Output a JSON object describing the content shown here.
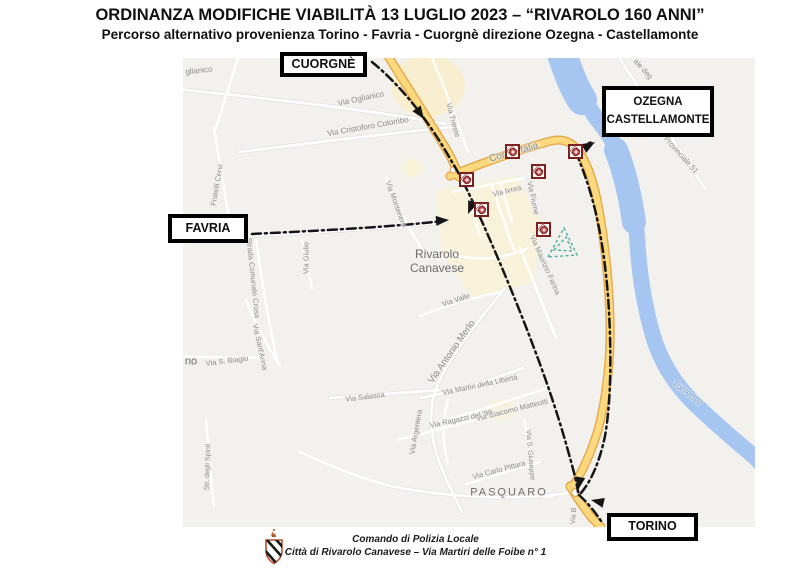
{
  "header": {
    "title": "ORDINANZA MODIFICHE VIABILITÀ 13 LUGLIO 2023 – “RIVAROLO 160 ANNI”",
    "subtitle": "Percorso alternativo provenienza Torino - Favria - Cuorgnè direzione Ozegna - Castellamonte"
  },
  "route_boxes": {
    "cuorgne": {
      "label": "CUORGNÈ"
    },
    "favria": {
      "label": "FAVRIA"
    },
    "ozegna": {
      "line1": "OZEGNA",
      "line2": "CASTELLAMONTE"
    },
    "torino": {
      "label": "TORINO"
    }
  },
  "map": {
    "colors": {
      "highlight_road": "#fcd97e",
      "highlight_casing": "#e4a94b",
      "route_dash": "#151515",
      "water": "#a6c6f1",
      "closure_marker_border": "#7b1f1f",
      "map_background": "#f2f1ee"
    },
    "town_labels": [
      {
        "lines": [
          "Rivarolo",
          "Canavese"
        ],
        "x": 437,
        "y": 262,
        "size": 12
      },
      {
        "lines": [
          "PASQUARO"
        ],
        "x": 509,
        "y": 493,
        "size": 11,
        "ls": 2
      },
      {
        "lines": [
          "no"
        ],
        "x": 191,
        "y": 362,
        "size": 11
      }
    ],
    "street_labels": [
      {
        "text": "glianico",
        "x": 199,
        "y": 71,
        "rot": -6,
        "size": 8
      },
      {
        "text": "Via Oglianico",
        "x": 361,
        "y": 99,
        "rot": -12,
        "size": 8
      },
      {
        "text": "Via Cristoforo Colombo",
        "x": 368,
        "y": 127,
        "rot": -10,
        "size": 8
      },
      {
        "text": "Fratelli Cervi",
        "x": 217,
        "y": 185,
        "rot": -80,
        "size": 7.5
      },
      {
        "text": "Via Trieste",
        "x": 453,
        "y": 120,
        "rot": 75,
        "size": 7.5
      },
      {
        "text": "Corso Italia",
        "x": 514,
        "y": 153,
        "rot": -16,
        "size": 10
      },
      {
        "text": "Via Ivrea",
        "x": 507,
        "y": 191,
        "rot": -14,
        "size": 7.5
      },
      {
        "text": "Via Fiume",
        "x": 533,
        "y": 198,
        "rot": 78,
        "size": 7.5
      },
      {
        "text": "Via Montenero",
        "x": 396,
        "y": 204,
        "rot": 70,
        "size": 7.5
      },
      {
        "text": "Via Giulio",
        "x": 306,
        "y": 258,
        "rot": -90,
        "size": 7.5
      },
      {
        "text": "Strada Comunale Crosa",
        "x": 253,
        "y": 278,
        "rot": 84,
        "size": 7.5
      },
      {
        "text": "Via Sant'Anna",
        "x": 260,
        "y": 347,
        "rot": 78,
        "size": 7.5
      },
      {
        "text": "Via S. Biagio",
        "x": 227,
        "y": 361,
        "rot": -7,
        "size": 7.5
      },
      {
        "text": "Str. degli Spinti",
        "x": 208,
        "y": 467,
        "rot": -88,
        "size": 7
      },
      {
        "text": "Via Valle",
        "x": 456,
        "y": 300,
        "rot": -18,
        "size": 7.5
      },
      {
        "text": "Via Antonio Merlo",
        "x": 452,
        "y": 352,
        "rot": -55,
        "size": 9.5
      },
      {
        "text": "Via Salassa",
        "x": 365,
        "y": 397,
        "rot": -7,
        "size": 7.5
      },
      {
        "text": "Via Martiri della Libertà",
        "x": 480,
        "y": 385,
        "rot": -12,
        "size": 7.5
      },
      {
        "text": "Via Giacomo Matteotti",
        "x": 512,
        "y": 410,
        "rot": -14,
        "size": 7.5
      },
      {
        "text": "Via Ragazzi del '99",
        "x": 461,
        "y": 419,
        "rot": -12,
        "size": 7.5
      },
      {
        "text": "Via Argentera",
        "x": 416,
        "y": 432,
        "rot": -80,
        "size": 7.5
      },
      {
        "text": "Via S. Giuseppe",
        "x": 530,
        "y": 455,
        "rot": 85,
        "size": 7
      },
      {
        "text": "Via Carlo Pittara",
        "x": 499,
        "y": 470,
        "rot": -15,
        "size": 7.5
      },
      {
        "text": "Via Maurizio Farina",
        "x": 545,
        "y": 265,
        "rot": 66,
        "size": 7.5
      },
      {
        "text": "Via B",
        "x": 574,
        "y": 516,
        "rot": -85,
        "size": 7
      },
      {
        "text": "Provinciale 51",
        "x": 681,
        "y": 155,
        "rot": 48,
        "size": 7.5
      },
      {
        "text": "ale deg",
        "x": 643,
        "y": 69,
        "rot": 48,
        "size": 7.5
      },
      {
        "text": "Torrente",
        "x": 687,
        "y": 393,
        "rot": 36,
        "size": 9.5,
        "type": "water"
      }
    ],
    "closure_markers": [
      {
        "x": 467,
        "y": 180
      },
      {
        "x": 513,
        "y": 152
      },
      {
        "x": 576,
        "y": 152
      },
      {
        "x": 539,
        "y": 172
      },
      {
        "x": 482,
        "y": 210
      },
      {
        "x": 544,
        "y": 230
      }
    ]
  },
  "footer": {
    "line1": "Comando di Polizia Locale",
    "line2": "Città di Rivarolo Canavese – Via Martiri delle Foibe n° 1"
  }
}
